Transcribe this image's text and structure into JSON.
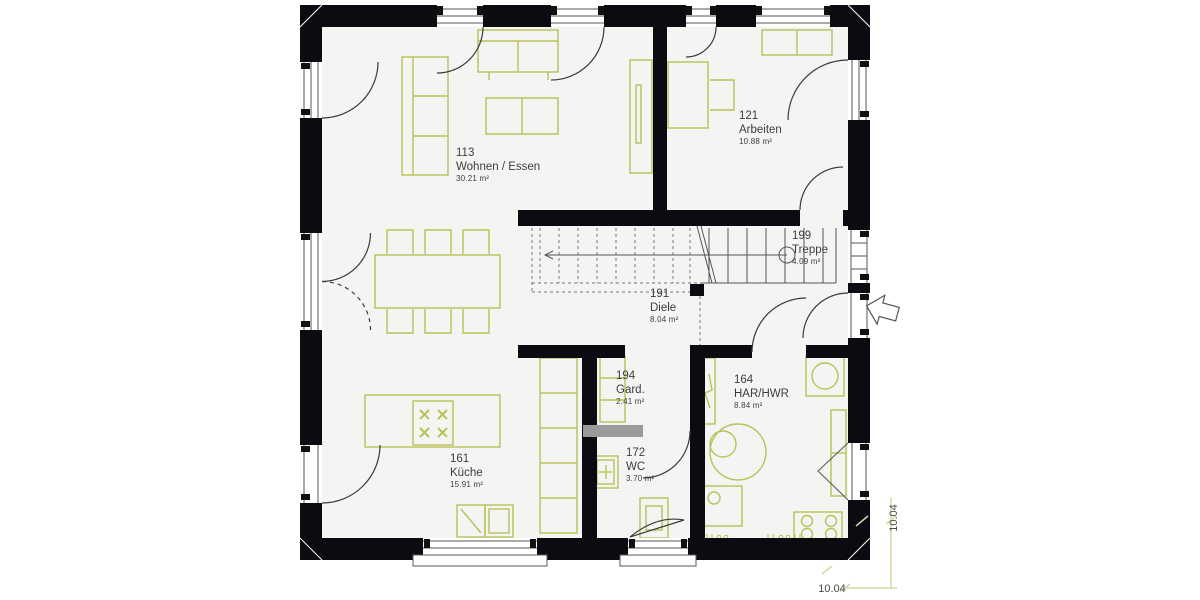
{
  "plan": {
    "title": "Erdgeschoss Grundriss",
    "rooms": [
      {
        "id": "113",
        "name": "Wohnen / Essen",
        "area": "30.21 m²"
      },
      {
        "id": "121",
        "name": "Arbeiten",
        "area": "10.88 m²"
      },
      {
        "id": "199",
        "name": "Treppe",
        "area": "4.09 m²"
      },
      {
        "id": "191",
        "name": "Diele",
        "area": "8.04 m²"
      },
      {
        "id": "194",
        "name": "Gard.",
        "area": "2.41 m²"
      },
      {
        "id": "164",
        "name": "HAR/HWR",
        "area": "8.84 m²"
      },
      {
        "id": "161",
        "name": "Küche",
        "area": "15.91 m²"
      },
      {
        "id": "172",
        "name": "WC",
        "area": "3.70 m²"
      }
    ],
    "dimensions": {
      "bottom": "10.04",
      "right": "10.04"
    },
    "colors": {
      "wall": "#0b0b12",
      "furniture": "#b9c257",
      "dimension_line": "#d6d9a4",
      "floor": "#f4f4f2",
      "line": "#3a3a3a",
      "text": "#3d3d3d",
      "partition_gray": "#9a9a9a"
    }
  }
}
